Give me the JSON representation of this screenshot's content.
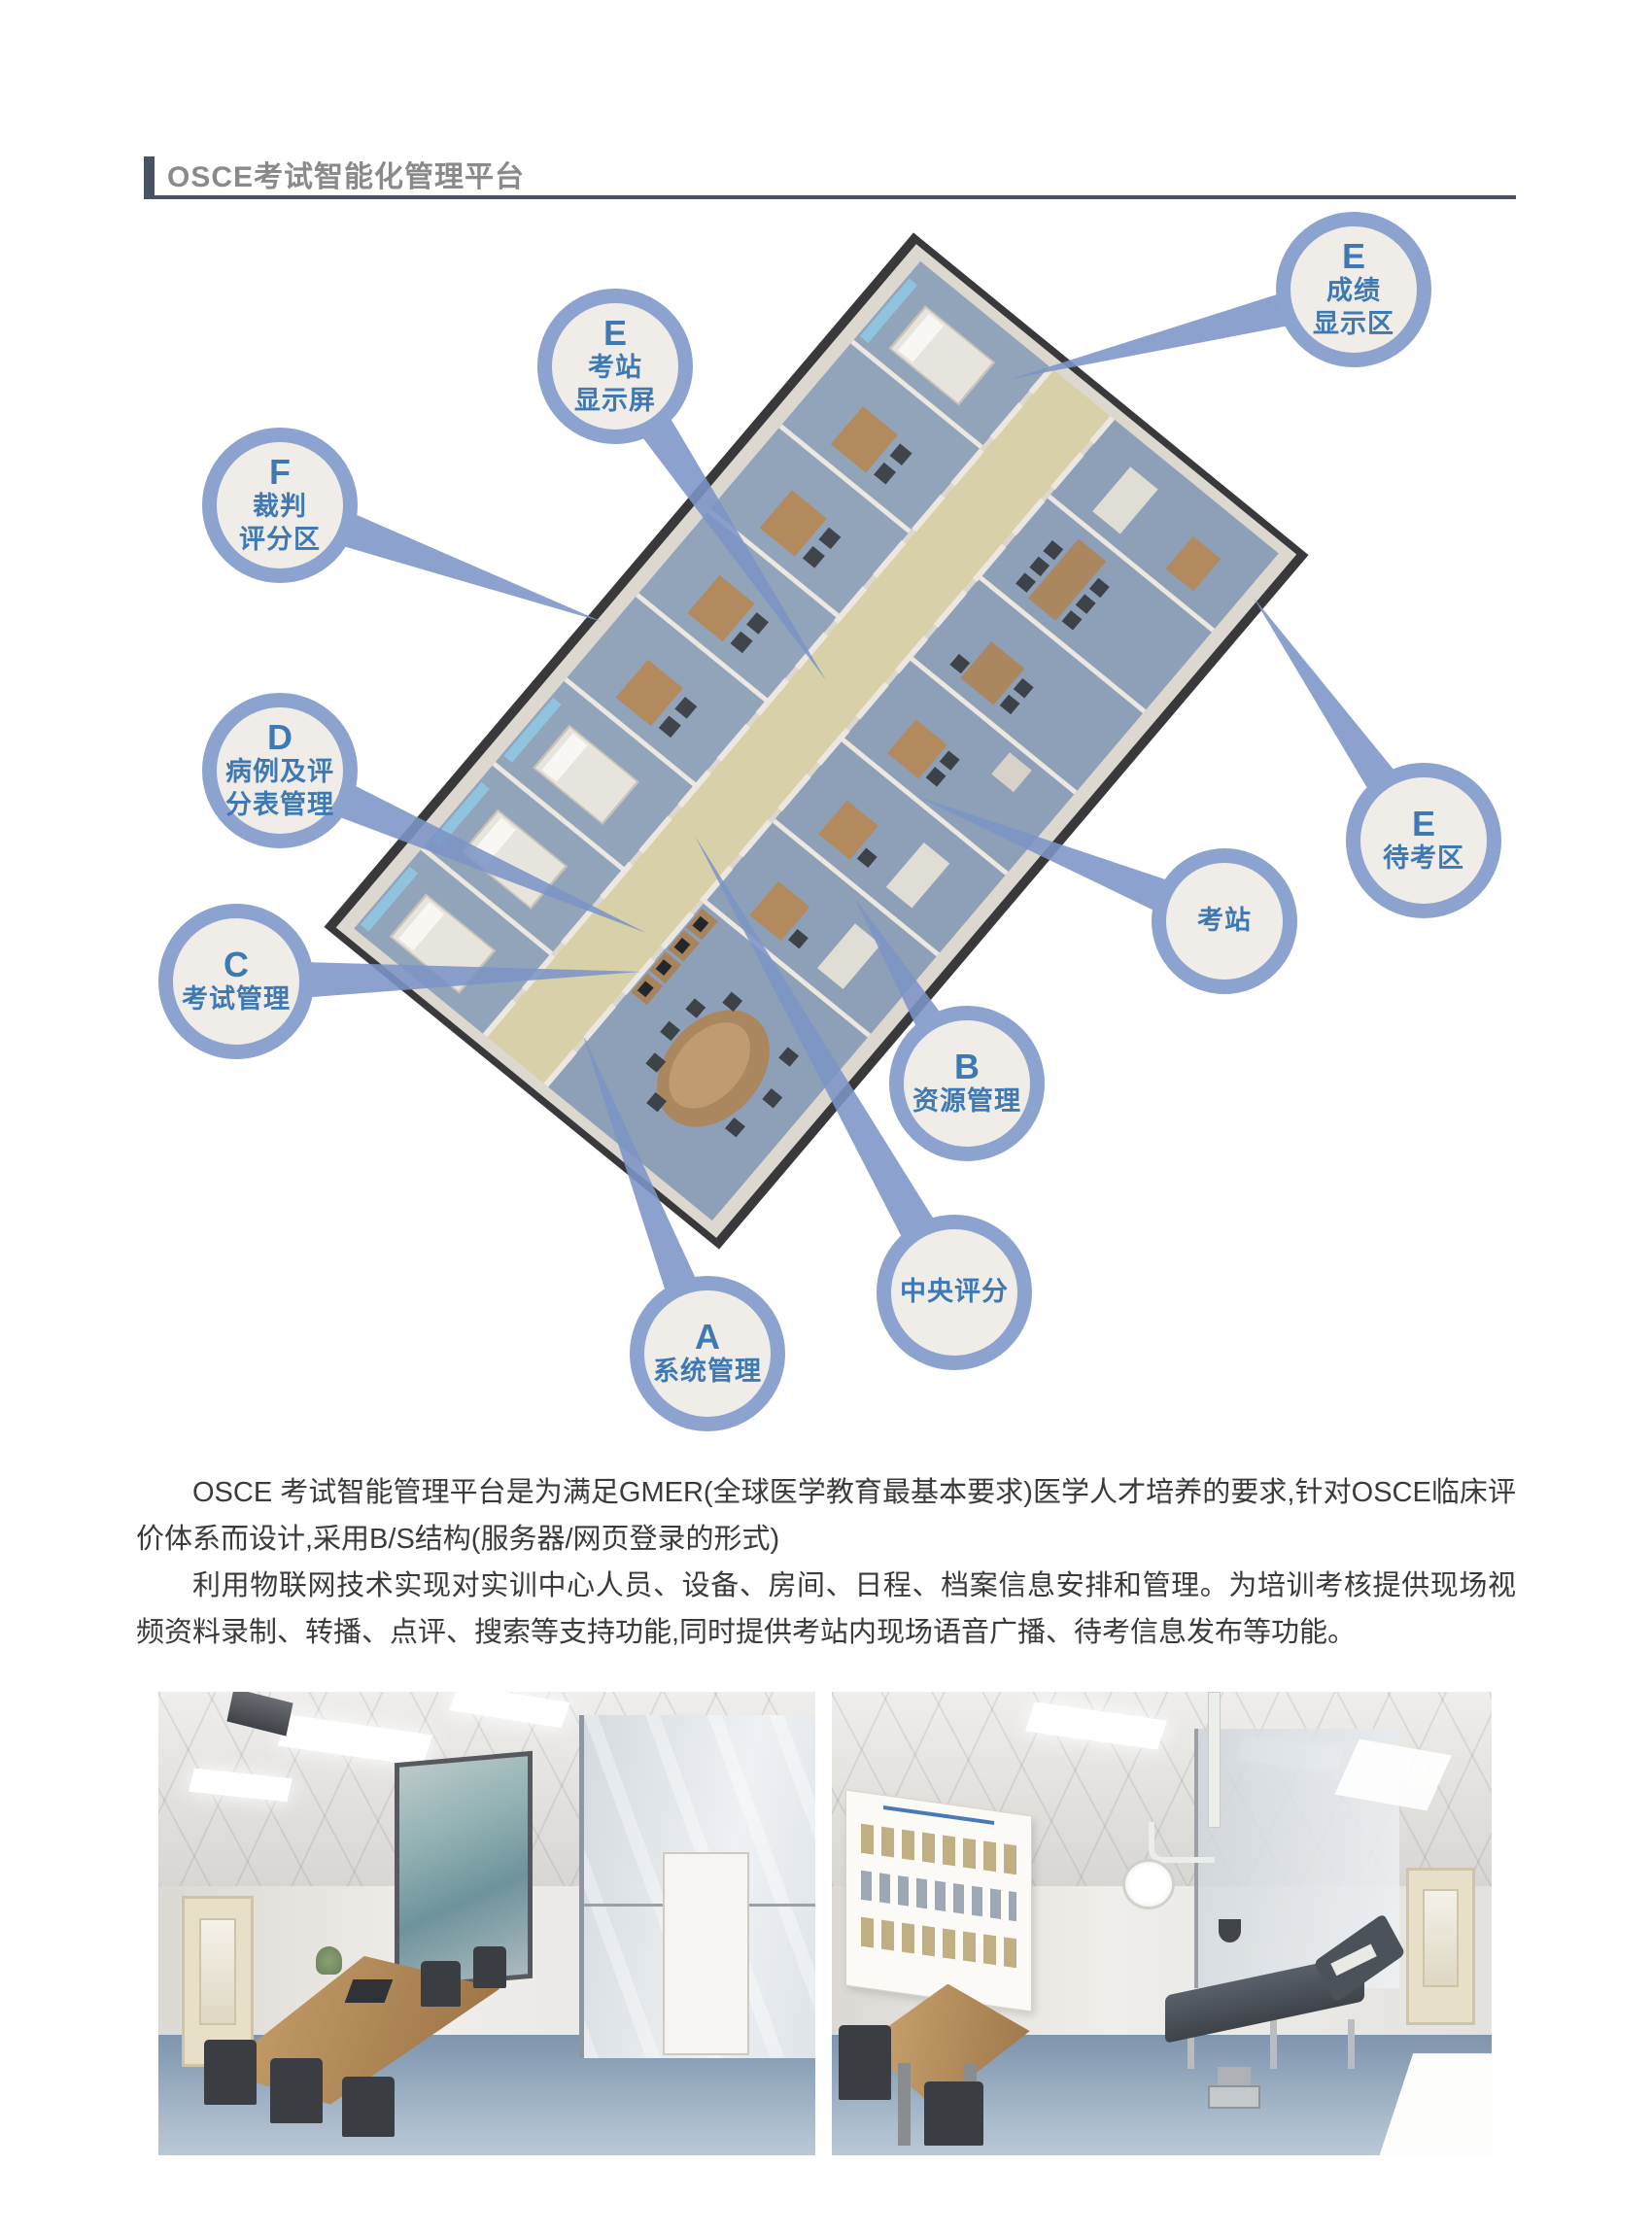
{
  "header": {
    "title": "OSCE考试智能化管理平台"
  },
  "callouts": [
    {
      "letter": "E",
      "line1": "考站",
      "line2": "显示屏"
    },
    {
      "letter": "E",
      "line1": "成绩",
      "line2": "显示区"
    },
    {
      "letter": "F",
      "line1": "裁判",
      "line2": "评分区"
    },
    {
      "letter": "D",
      "line1": "病例及评",
      "line2": "分表管理"
    },
    {
      "letter": "C",
      "line1": "考试管理"
    },
    {
      "letter": "E",
      "line1": "待考区"
    },
    {
      "line1": "考站"
    },
    {
      "letter": "B",
      "line1": "资源管理"
    },
    {
      "line1": "中央评分"
    },
    {
      "letter": "A",
      "line1": "系统管理"
    }
  ],
  "paragraphs": {
    "p1": "OSCE 考试智能管理平台是为满足GMER(全球医学教育最基本要求)医学人才培养的要求,针对OSCE临床评价体系而设计,采用B/S结构(服务器/网页登录的形式)",
    "p2": "利用物联网技术实现对实训中心人员、设备、房间、日程、档案信息安排和管理。为培训考核提供现场视频资料录制、转播、点评、搜索等支持功能,同时提供考站内现场语音广播、待考信息发布等功能。"
  },
  "colors": {
    "header_bar": "#4a5365",
    "header_title_text": "#8a8a8a",
    "bubble_ring": "#8ba3ce",
    "bubble_fill": "#f0ede8",
    "bubble_text": "#3e79b4",
    "connector": "#7c94c6",
    "corridor_floor": "#d8d0a8",
    "room_floor": "#8da0b7",
    "body_text": "#3a3a3a"
  }
}
